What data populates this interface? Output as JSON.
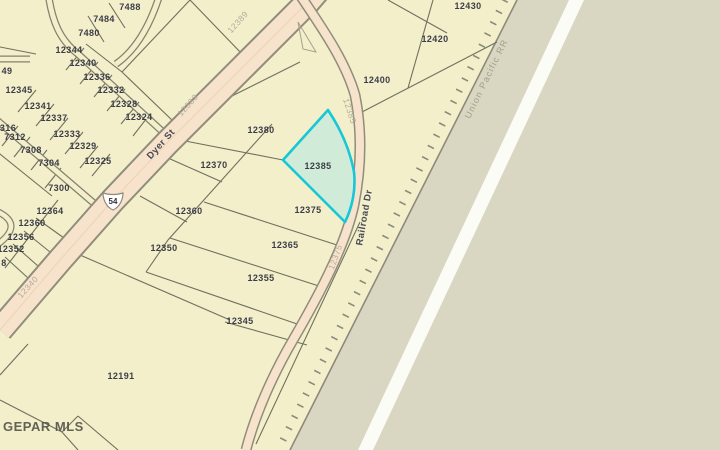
{
  "map": {
    "watermark": "GEPAR MLS",
    "highway_shield": "54",
    "highlighted_parcel": "12385",
    "colors": {
      "parcel_area": "#f2efca",
      "offmap_area": "#d9d6c1",
      "road_fill": "#f7e3cc",
      "road_casing": "#908d7c",
      "parcel_line": "#70705f",
      "railroad": "#8b8b7c",
      "highlight_stroke": "#17c7d7",
      "highlight_fill": "#d0ebd8",
      "white_stripe": "#fcfcf7"
    },
    "parcel_labels": [
      {
        "text": "7488",
        "x": 130,
        "y": 10
      },
      {
        "text": "7484",
        "x": 104,
        "y": 22
      },
      {
        "text": "7480",
        "x": 89,
        "y": 36
      },
      {
        "text": "12344",
        "x": 69,
        "y": 53
      },
      {
        "text": "12340",
        "x": 83,
        "y": 66
      },
      {
        "text": "12336",
        "x": 97,
        "y": 80
      },
      {
        "text": "12332",
        "x": 111,
        "y": 93
      },
      {
        "text": "12328",
        "x": 124,
        "y": 107
      },
      {
        "text": "12324",
        "x": 139,
        "y": 120
      },
      {
        "text": "12345",
        "x": 19,
        "y": 93
      },
      {
        "text": "12341",
        "x": 38,
        "y": 109
      },
      {
        "text": "12337",
        "x": 54,
        "y": 121
      },
      {
        "text": "12333",
        "x": 67,
        "y": 137
      },
      {
        "text": "12329",
        "x": 83,
        "y": 149
      },
      {
        "text": "12325",
        "x": 98,
        "y": 164
      },
      {
        "text": "49",
        "x": 7,
        "y": 74
      },
      {
        "text": "316",
        "x": 8,
        "y": 131
      },
      {
        "text": "7312",
        "x": 15,
        "y": 140
      },
      {
        "text": "7308",
        "x": 31,
        "y": 153
      },
      {
        "text": "7304",
        "x": 49,
        "y": 166
      },
      {
        "text": "7300",
        "x": 59,
        "y": 191
      },
      {
        "text": "12364",
        "x": 50,
        "y": 214
      },
      {
        "text": "12360",
        "x": 32,
        "y": 226
      },
      {
        "text": "12356",
        "x": 21,
        "y": 240
      },
      {
        "text": "12352",
        "x": 11,
        "y": 252
      },
      {
        "text": "8",
        "x": 4,
        "y": 266
      },
      {
        "text": "12380",
        "x": 261,
        "y": 133
      },
      {
        "text": "12370",
        "x": 214,
        "y": 168
      },
      {
        "text": "12360",
        "x": 189,
        "y": 214
      },
      {
        "text": "12350",
        "x": 164,
        "y": 251
      },
      {
        "text": "12385",
        "x": 318,
        "y": 169
      },
      {
        "text": "12375",
        "x": 308,
        "y": 213
      },
      {
        "text": "12365",
        "x": 285,
        "y": 248
      },
      {
        "text": "12355",
        "x": 261,
        "y": 281
      },
      {
        "text": "12345",
        "x": 240,
        "y": 324
      },
      {
        "text": "12400",
        "x": 377,
        "y": 83
      },
      {
        "text": "12420",
        "x": 435,
        "y": 42
      },
      {
        "text": "12430",
        "x": 468,
        "y": 9
      },
      {
        "text": "12191",
        "x": 121,
        "y": 379
      }
    ],
    "road_labels": [
      {
        "text": "Dyer St",
        "x": 163,
        "y": 146,
        "rot": -48,
        "cls": "road"
      },
      {
        "text": "Railroad Dr",
        "x": 367,
        "y": 218,
        "rot": -80,
        "cls": "road"
      },
      {
        "text": "Union Pacific RR",
        "x": 489,
        "y": 80,
        "rot": -64,
        "cls": "rr"
      },
      {
        "text": "12389",
        "x": 240,
        "y": 24,
        "rot": -48,
        "cls": "faint"
      },
      {
        "text": "12383",
        "x": 190,
        "y": 107,
        "rot": -48,
        "cls": "faint"
      },
      {
        "text": "12340",
        "x": 30,
        "y": 289,
        "rot": -48,
        "cls": "faint"
      },
      {
        "text": "12385",
        "x": 347,
        "y": 112,
        "rot": 72,
        "cls": "faint"
      },
      {
        "text": "12375",
        "x": 338,
        "y": 258,
        "rot": -70,
        "cls": "faint"
      }
    ]
  }
}
